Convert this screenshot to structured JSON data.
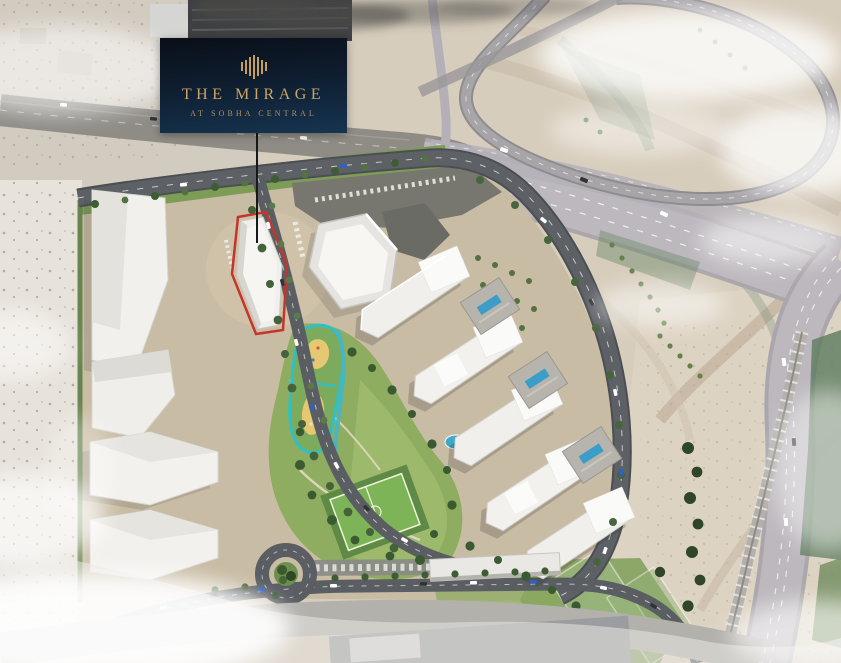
{
  "project_card": {
    "logo_icon": "sobha-skyline-bars-icon",
    "title": "THE MIRAGE",
    "subtitle": "AT SOBHA CENTRAL",
    "colors": {
      "card_top": "#0a0f18",
      "card_bottom": "#163450",
      "gold": "#c59e58"
    }
  },
  "masterplan": {
    "type": "aerial-masterplan-rendering",
    "highlighted_plot": {
      "name": "the-mirage-plot",
      "outline_color": "#c5352c",
      "leader_line_color": "#17181a"
    },
    "features": [
      "desert-terrain",
      "existing-highway",
      "highway-interchange-loop",
      "main-highway",
      "rail-line",
      "warehouse-with-smoke",
      "white-podium-buildings",
      "hexagonal-pavilion",
      "residential-towers",
      "amenity-podiums-with-pools",
      "central-park",
      "playground",
      "water-stream",
      "sports-field",
      "tennis-courts",
      "roundabout",
      "tree-lined-boulevard",
      "parking-rows",
      "clouds",
      "faded-existing-context"
    ],
    "colors": {
      "sand": "#d7cdbc",
      "site_ground": "#c9bca4",
      "park_green": "#8fad60",
      "road": "#5a5e62",
      "highway": "#b9b4ba",
      "building_white": "#f2f1ee",
      "playground_teal": "#2fc0c5",
      "playground_sand": "#e6c873",
      "pool_blue": "#3fa9c9"
    }
  }
}
